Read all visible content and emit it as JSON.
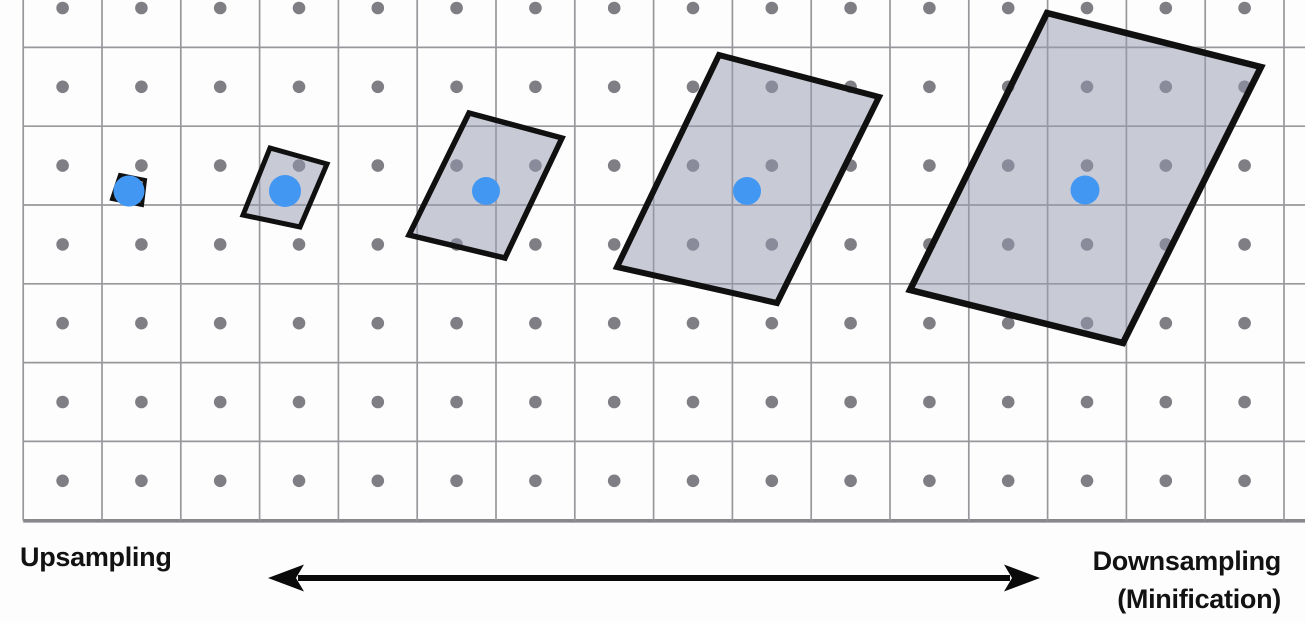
{
  "diagram": {
    "title_semantics": "Texture sampling footprint diagram",
    "left_label": "Upsampling",
    "right_label_line1": "Downsampling",
    "right_label_line2": "(Minification)",
    "colors": {
      "background": "#fdfdfd",
      "grid_line": "#98989c",
      "grid_bottom_line": "#88888c",
      "texel_dot": "#7e7e84",
      "sample_point_blue": "#4297f2",
      "footprint_fill": "rgba(148,152,176,0.5)",
      "footprint_stroke": "#101010",
      "label_text": "#121212",
      "arrow": "#0a0a0a"
    },
    "grid": {
      "x0": 23.2,
      "y0": 47.4,
      "cell": 78.8,
      "cols": 16,
      "rows": 6,
      "dot_rows": 7,
      "dot_radius": 6.3,
      "bottom_y": 520.8,
      "bottom_stroke": 3.6,
      "line_stroke": 1.7,
      "width": 1305,
      "height": 623
    },
    "footprints": [
      {
        "points": [
          [
            120,
            175
          ],
          [
            145,
            180
          ],
          [
            142,
            205
          ],
          [
            112,
            199
          ]
        ],
        "stroke_width": 4
      },
      {
        "points": [
          [
            270,
            148
          ],
          [
            327,
            164
          ],
          [
            300,
            227
          ],
          [
            243,
            215
          ]
        ],
        "stroke_width": 5
      },
      {
        "points": [
          [
            469,
            113
          ],
          [
            562,
            138
          ],
          [
            505,
            258
          ],
          [
            409,
            235
          ]
        ],
        "stroke_width": 5.5
      },
      {
        "points": [
          [
            719,
            55
          ],
          [
            879,
            97
          ],
          [
            777,
            303
          ],
          [
            617,
            267
          ]
        ],
        "stroke_width": 6
      },
      {
        "points": [
          [
            1047,
            13
          ],
          [
            1261,
            67
          ],
          [
            1123,
            343
          ],
          [
            910,
            290
          ]
        ],
        "stroke_width": 6.5
      }
    ],
    "samples": [
      {
        "cx": 129,
        "cy": 191,
        "r": 15.5
      },
      {
        "cx": 285,
        "cy": 191,
        "r": 16
      },
      {
        "cx": 486,
        "cy": 191,
        "r": 14
      },
      {
        "cx": 747,
        "cy": 191,
        "r": 14
      },
      {
        "cx": 1085,
        "cy": 190,
        "r": 14.5
      }
    ],
    "arrow": {
      "x1": 268,
      "x2": 1040,
      "y": 578,
      "shaft_width": 6,
      "head_length": 36,
      "head_half_height": 13.5
    }
  }
}
